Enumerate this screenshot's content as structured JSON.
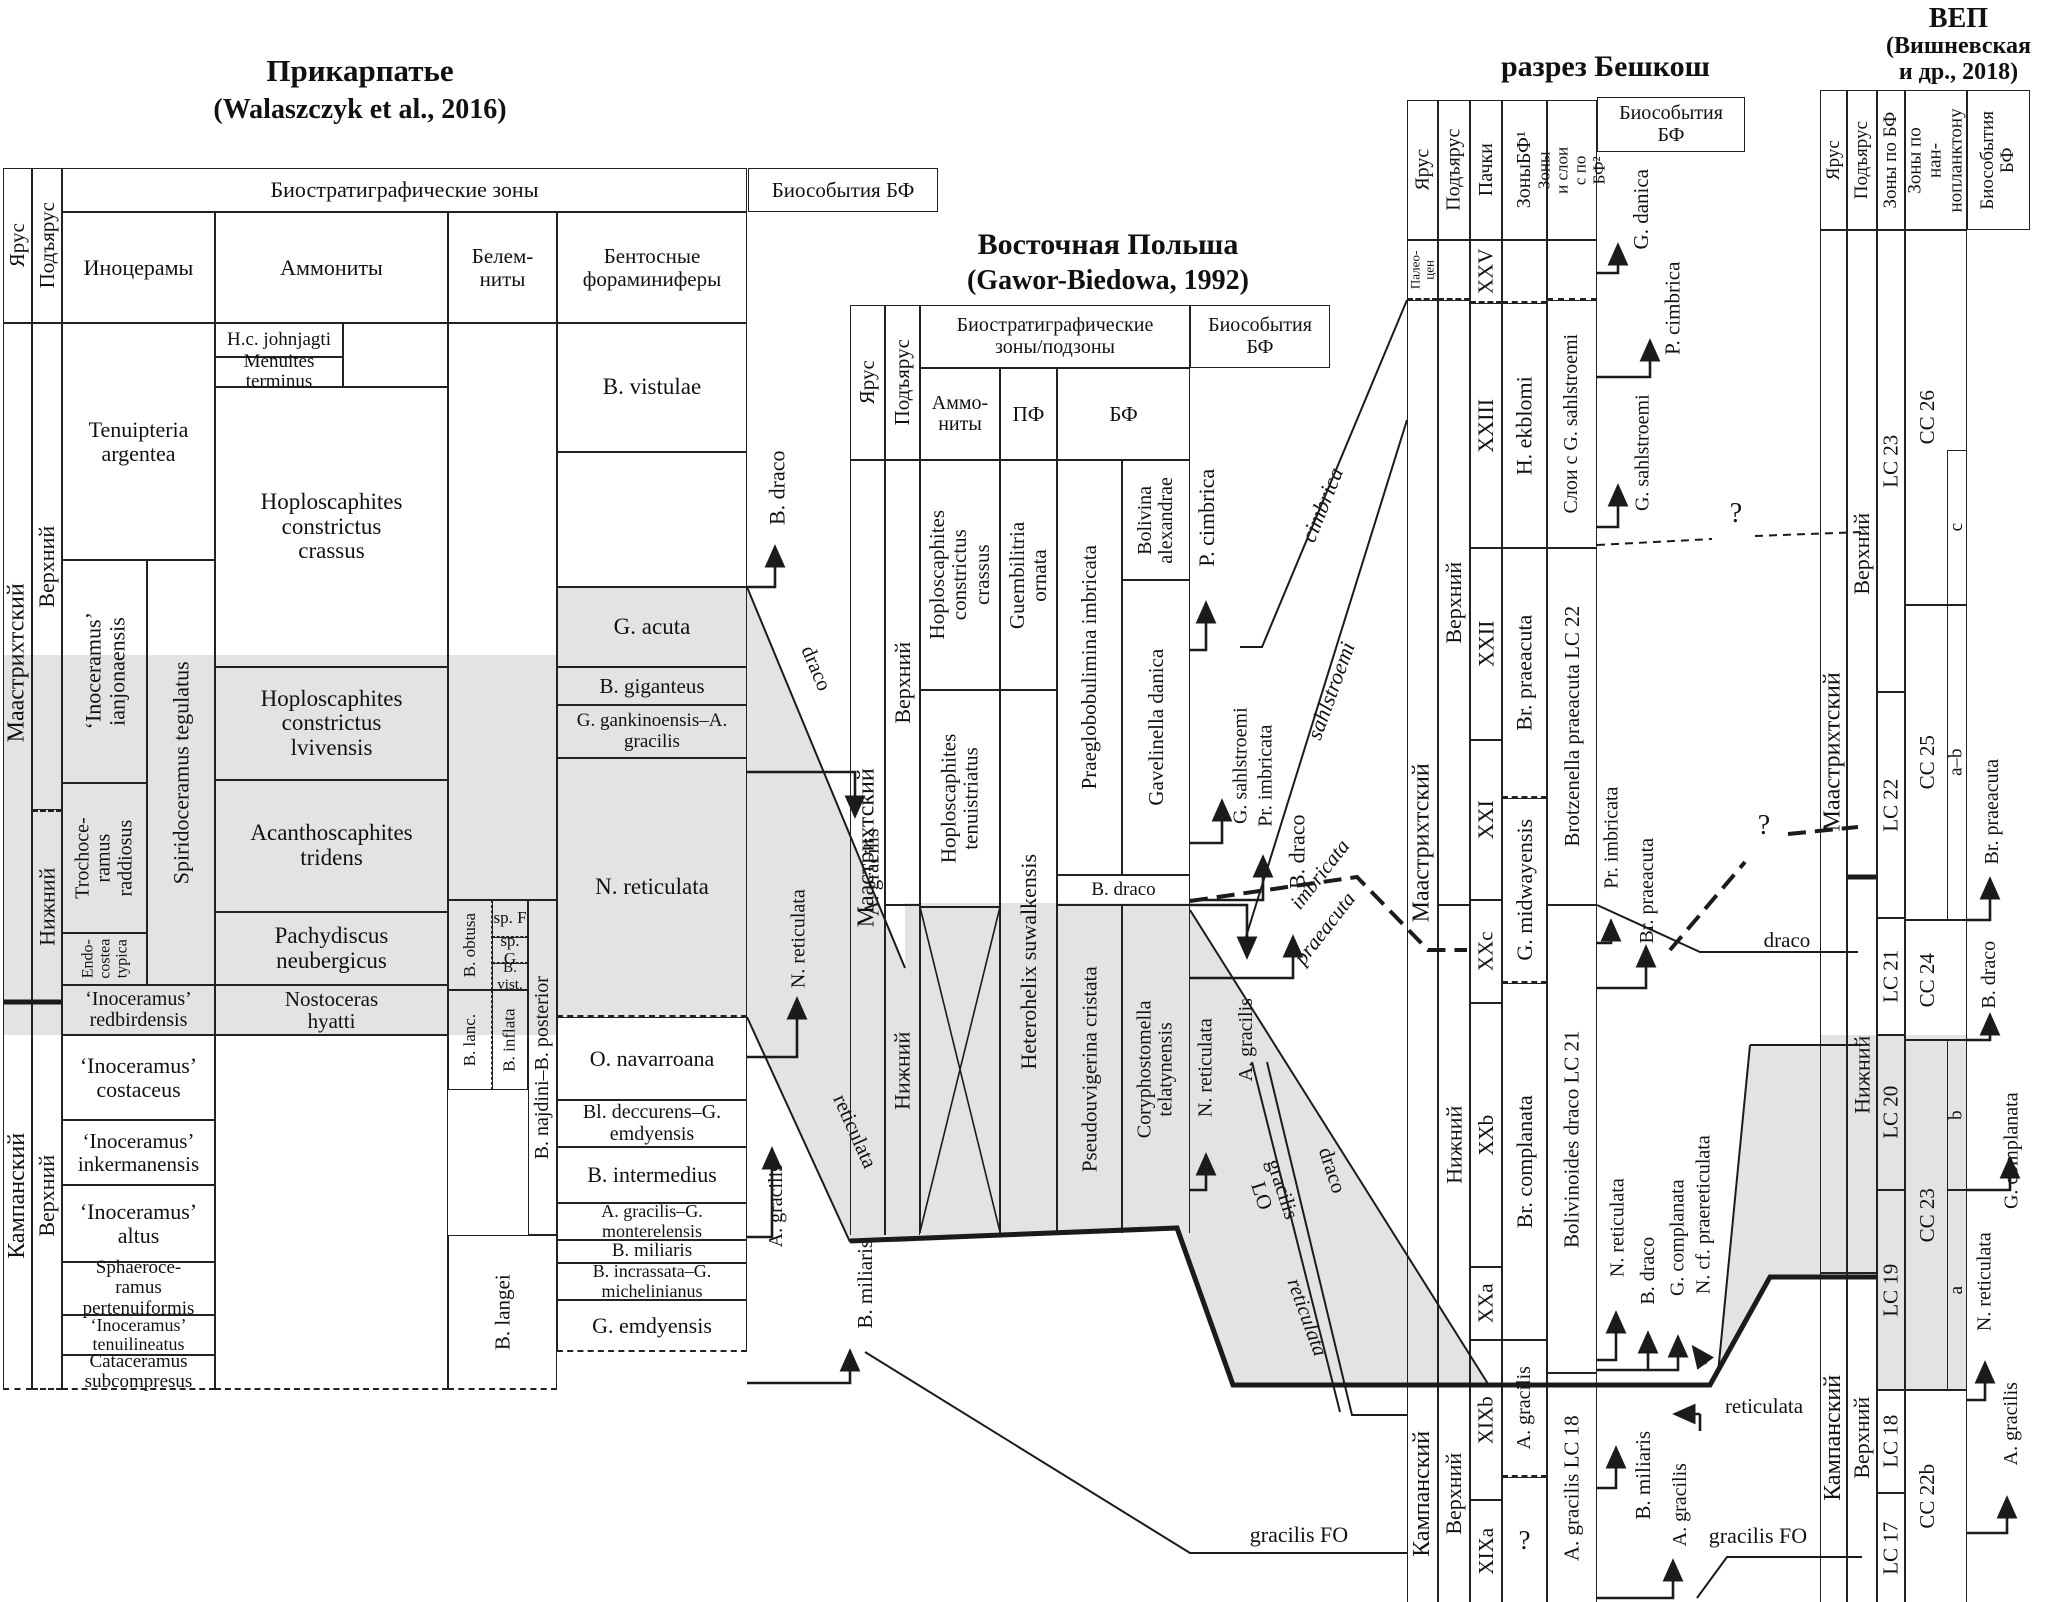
{
  "colors": {
    "band_gray": "#e3e3e3",
    "ink": "#1b1b1b"
  },
  "p1": {
    "title": "Прикарпатье",
    "subtitle": "(Walaszczyk et al., 2016)",
    "h": {
      "stage": "Ярус",
      "substage": "Подъярус",
      "biozones": "Биостратиграфические зоны",
      "inoceramus": "Иноцерамы",
      "ammonites": "Аммониты",
      "belemnites": "Белем-ниты",
      "forams": "Бентосные фораминиферы",
      "bioevents": "Биособытия БФ"
    },
    "stage": [
      "Маастрихтский",
      "Кампанский"
    ],
    "substage": [
      "Верхний",
      "Нижний",
      "Верхний"
    ],
    "inoc": [
      "Tenuipteria argentea",
      "‘Inoceramus’ ianjonaensis",
      "Spiridoceramus tegulatus",
      "Trochoce-ramus raddiosus",
      "Endo-costea typica",
      "‘Inoceramus’ redbirdensis",
      "‘Inoceramus’ costaceus",
      "‘Inoceramus’ inkermanensis",
      "‘Inoceramus’ altus",
      "Sphaeroce-ramus pertenuiformis",
      "‘Inoceramus’ tenuilineatus",
      "Cataceramus subcompresus"
    ],
    "amm": [
      "H.c. johnjagti",
      "Menuites terminus",
      "Hoploscaphites constrictus crassus",
      "Hoploscaphites constrictus lvivensis",
      "Acanthoscaphites tridens",
      "Pachydiscus neubergicus",
      "Nostoceras hyatti"
    ],
    "bel": [
      "B. obtusa",
      "sp. F",
      "sp. G",
      "B. vist.",
      "B. lanc.",
      "B. inflata",
      "B. najdini–B. posterior",
      "B. langei"
    ],
    "foram": [
      "B. vistulae",
      "G. acuta",
      "B. giganteus",
      "G. gankinoensis–A. gracilis",
      "N. reticulata",
      "O. navarroana",
      "Bl. deccurens–G. emdyensis",
      "B. intermedius",
      "A. gracilis–G. monterelensis",
      "B. miliaris",
      "B. incrassata–G. michelinianus",
      "G. emdyensis"
    ],
    "events": [
      "B. draco",
      "A. gracilis",
      "N. reticulata",
      "A. gracilis",
      "B. miliaris"
    ],
    "ties": [
      "draco",
      "reticulata"
    ]
  },
  "p2": {
    "title": "Восточная Польша",
    "subtitle": "(Gawor-Biedowa, 1992)",
    "h": {
      "stage": "Ярус",
      "substage": "Подъярус",
      "biozones": "Биостратиграфические зоны/подзоны",
      "ammonites": "Аммо-ниты",
      "pf": "ПФ",
      "bf": "БФ",
      "bioevents": "Биособытия БФ"
    },
    "stage": "Маастрихтский",
    "substage": [
      "Верхний",
      "Нижний"
    ],
    "amm": [
      "Hoploscaphites constrictus crassus",
      "Hoploscaphites tenuistriatus"
    ],
    "pf": [
      "Guembilitria ornata",
      "Heterohelix suwalkensis"
    ],
    "bf": [
      "Praeglobobulimina imbricata",
      "Bolivina alexandrae",
      "Gavelinella danica",
      "B. draco",
      "Pseudouvigerina cristata",
      "Coryphostomella telatynensis"
    ],
    "events": [
      "P. cimbrica",
      "G. sahlstroemi",
      "Pr. imbricata",
      "B. draco",
      "A. gracilis",
      "N. reticulata"
    ],
    "ties": [
      "cimbrica",
      "sahlstroemi",
      "imbricata",
      "praeacuta",
      "draco",
      "gracilis LO",
      "reticulata",
      "gracilis FO"
    ]
  },
  "p3": {
    "title": "разрез Бешкош",
    "h": {
      "stage": "Ярус",
      "substage": "Подъярус",
      "packets": "Пачки",
      "zones_bf": "ЗоныБФ¹",
      "zones_layers": "Зоны и слои с по БФ²",
      "bioevents": "Биособытия БФ"
    },
    "stage": [
      "Палео-цен",
      "Маастрихтский",
      "Кампанский"
    ],
    "substage": [
      "Верхний",
      "Нижний",
      "Верхний"
    ],
    "packets": [
      "XXV",
      "XXIII",
      "XXII",
      "XXI",
      "XXc",
      "XXb",
      "XXa",
      "XIXb",
      "XIXa"
    ],
    "zones_bf": [
      "H. ekblomi",
      "Br. praeacuta",
      "G. midwayensis",
      "Br. complanata",
      "A. gracilis",
      "?"
    ],
    "zones_layers": [
      "Слои с G. sahlstroemi",
      "Brotzenella praeacuta LC 22",
      "Bolivinoides draco LC 21",
      "A. gracilis LC 18"
    ],
    "events": [
      "G. danica",
      "P. cimbrica",
      "G. sahlstroemi",
      "Pr. imbricata",
      "Br. praeacuta",
      "N. reticulata",
      "B. draco",
      "G. complanata",
      "N. cf. praereticulata",
      "B. miliaris",
      "A. gracilis"
    ],
    "ties": [
      "draco",
      "reticulata",
      "gracilis FO"
    ],
    "qmark": "?"
  },
  "p4": {
    "title_lines": [
      "ВЕП",
      "(Вишневская",
      "и др., 2018)"
    ],
    "h": {
      "stage": "Ярус",
      "substage": "Подъярус",
      "zones_bf": "Зоны по БФ",
      "zones_nanno": "Зоны по нан-нопланктону",
      "bioevents": "Биособытия БФ"
    },
    "stage": [
      "Маастрихтский",
      "Кампанский"
    ],
    "substage": [
      "Верхний",
      "Нижний",
      "Верхний"
    ],
    "lc": [
      "LC 23",
      "LC 22",
      "LC 21",
      "LC 20",
      "LC 19",
      "LC 18",
      "LC 17"
    ],
    "cc": [
      "CC 26",
      "CC 25",
      "CC 24",
      "CC 23",
      "CC 22b"
    ],
    "sub": [
      "c",
      "a–b",
      "b",
      "a"
    ],
    "events": [
      "Br. praeacuta",
      "B. draco",
      "G. complanata",
      "N. reticulata",
      "A. gracilis"
    ]
  },
  "misc": {
    "qmark": "?"
  }
}
